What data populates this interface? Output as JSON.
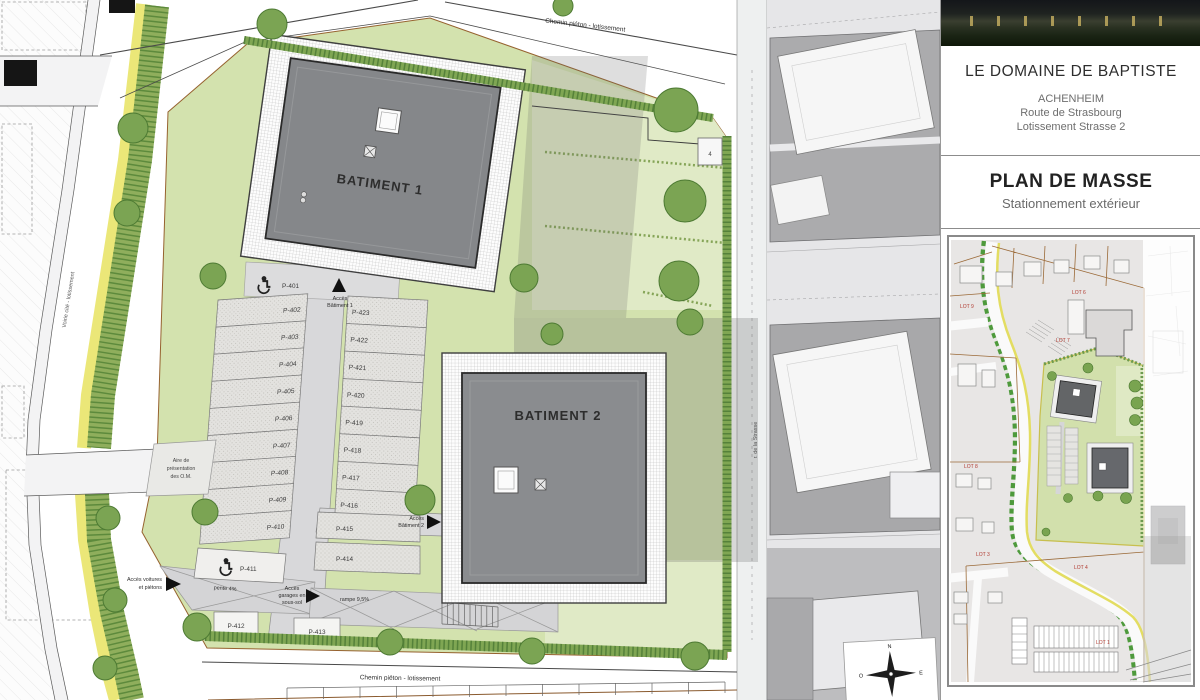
{
  "sidebar": {
    "project_title": "LE DOMAINE DE BAPTISTE",
    "location_line1": "ACHENHEIM",
    "location_line2": "Route de Strasbourg",
    "location_line3": "Lotissement Strasse 2",
    "plan_title": "PLAN DE MASSE",
    "plan_subtitle": "Stationnement extérieur",
    "minimap_lots": [
      "LOT 9",
      "LOT 6",
      "LOT 7",
      "LOT 8",
      "LOT 3",
      "LOT 4",
      "LOT 1"
    ]
  },
  "plan": {
    "building1_label": "BATIMENT 1",
    "building2_label": "BATIMENT 2",
    "path_top_label": "Chemin piéton - lotissement",
    "path_bottom_label": "Chemin piéton - lotissement",
    "road_left_label": "Voirie cité - lotissement",
    "road_right_label": "r. de la Strasse",
    "access_b1_line1": "Accès",
    "access_b1_line2": "Bâtiment 1",
    "access_b2_line1": "Accès",
    "access_b2_line2": "Bâtiment 2",
    "access_cars_line1": "Accès voitures",
    "access_cars_line2": "et piétons",
    "access_garage_line1": "Accès",
    "access_garage_line2": "garages en",
    "access_garage_line3": "sous-sol",
    "ramp_label": "rampe 9,5%",
    "slope_label": "pente 4%",
    "waste_area_line1": "Aire de",
    "waste_area_line2": "présentation",
    "waste_area_line3": "des O.M.",
    "box_marker": "4",
    "compass": {
      "n": "N",
      "e": "E",
      "s": "S",
      "o": "O"
    },
    "parking_left": [
      "P-402",
      "P-403",
      "P-404",
      "P-405",
      "P-406",
      "P-407",
      "P-408",
      "P-409",
      "P-410"
    ],
    "parking_right": [
      "P-423",
      "P-422",
      "P-421",
      "P-420",
      "P-419",
      "P-418",
      "P-417",
      "P-416"
    ],
    "parking_misc": {
      "p401": "P-401",
      "p411": "P-411",
      "p412": "P-412",
      "p413": "P-413",
      "p414": "P-414",
      "p415": "P-415"
    }
  }
}
